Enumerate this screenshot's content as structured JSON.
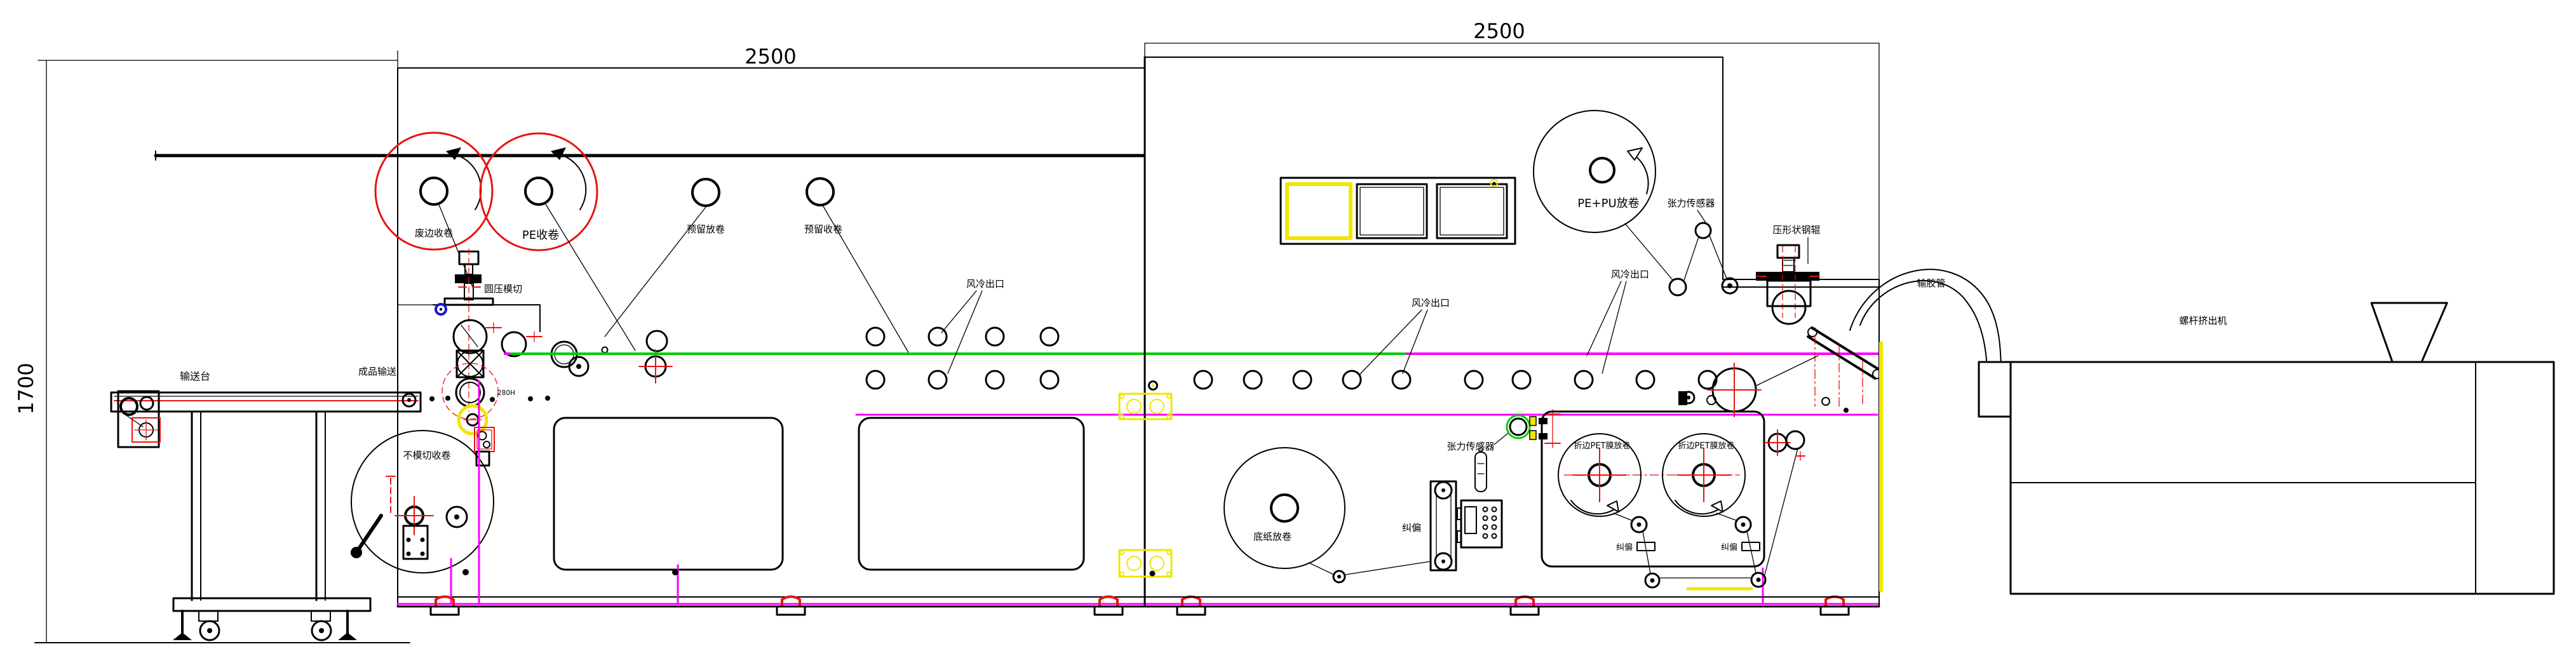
{
  "drawing": {
    "type": "machine-layout-cad",
    "dimensions": {
      "frame_left_width": "2500",
      "frame_right_width": "2500",
      "machine_height": "1700"
    },
    "labels": {
      "waste_edge_winder": "废边收卷",
      "pe_winder": "PE收卷",
      "reserved_unwinder": "预留放卷",
      "reserved_winder": "预留收卷",
      "rotary_die_cut": "圆压模切",
      "conveyor_table": "输送台",
      "finished_conveying": "成品输送",
      "non_diecut_winder": "不模切收卷",
      "roller_model": "280H",
      "air_cooling_outlet": "风冷出口",
      "pepu_unwinder": "PE+PU放卷",
      "tension_sensor": "张力传感器",
      "shaped_steel_roller": "压形状钢辊",
      "base_paper_unwinder": "底纸放卷",
      "web_guide": "纠偏",
      "pet_film_unwinder": "折边PET膜放卷",
      "glue_hose": "输胶管",
      "screw_extruder": "螺杆挤出机"
    },
    "colors": {
      "line": "#000000",
      "highlight_circle": "#e81212",
      "web_path_green": "#00cc00",
      "web_path_magenta": "#ff00ff",
      "highlight_yellow": "#f0e600",
      "highlight_blue": "#1515e0"
    }
  }
}
